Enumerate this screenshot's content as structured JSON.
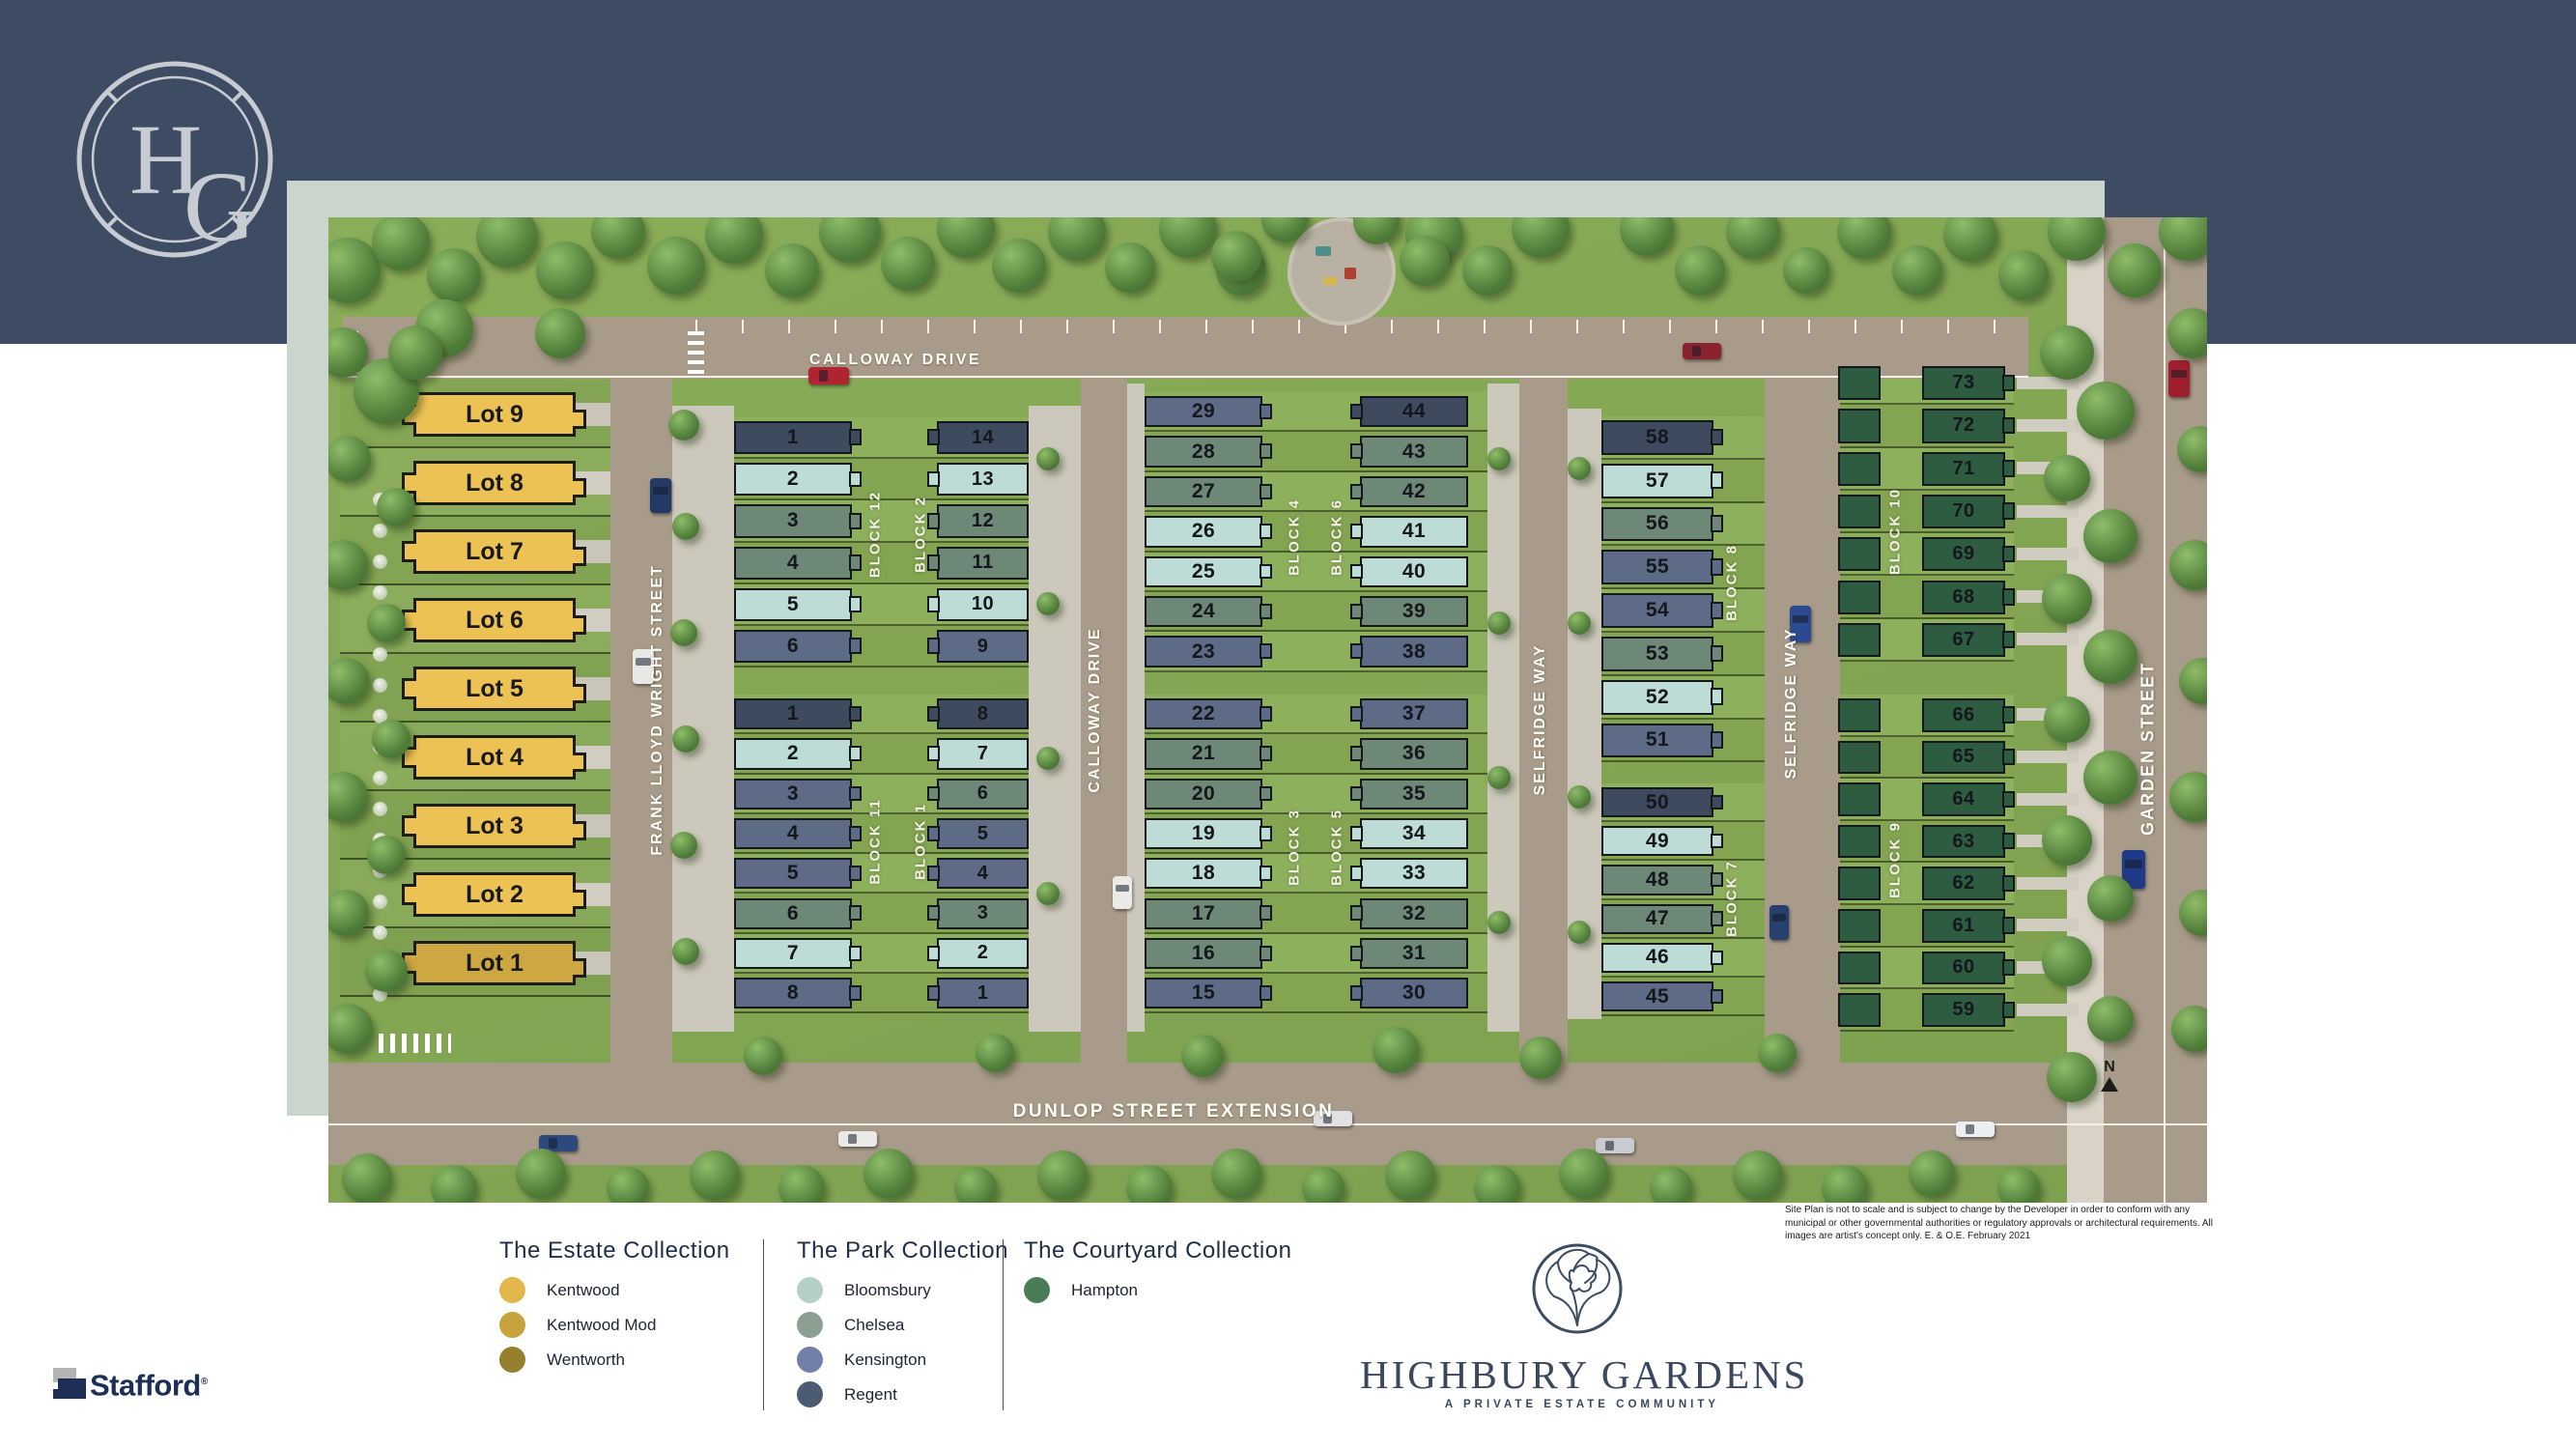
{
  "brand": {
    "monogram_h": "H",
    "monogram_g": "G"
  },
  "site": {
    "streets": {
      "calloway_top": "CALLOWAY DRIVE",
      "calloway_vertical": "CALLOWAY DRIVE",
      "frank_lloyd_wright": "FRANK LLOYD WRIGHT STREET",
      "selfridge_left": "SELFRIDGE WAY",
      "selfridge_right": "SELFRIDGE WAY",
      "garden": "GARDEN STREET",
      "dunlop": "DUNLOP STREET EXTENSION"
    },
    "north_label": "N",
    "estate_lots": [
      {
        "label": "Lot 9",
        "model": "kentwood"
      },
      {
        "label": "Lot 8",
        "model": "kentwood"
      },
      {
        "label": "Lot 7",
        "model": "kentwood"
      },
      {
        "label": "Lot 6",
        "model": "kentwood"
      },
      {
        "label": "Lot 5",
        "model": "kentwood"
      },
      {
        "label": "Lot 4",
        "model": "kentwood"
      },
      {
        "label": "Lot 3",
        "model": "kentwood"
      },
      {
        "label": "Lot 2",
        "model": "kentwood"
      },
      {
        "label": "Lot 1",
        "model": "kentwood_mod"
      }
    ],
    "blocks": {
      "block12": {
        "label": "BLOCK 12",
        "units": [
          [
            "1",
            "regent"
          ],
          [
            "2",
            "bloomsbury"
          ],
          [
            "3",
            "chelsea"
          ],
          [
            "4",
            "chelsea"
          ],
          [
            "5",
            "bloomsbury"
          ],
          [
            "6",
            "kensington"
          ]
        ]
      },
      "block2": {
        "label": "BLOCK 2",
        "units": [
          [
            "14",
            "regent"
          ],
          [
            "13",
            "bloomsbury"
          ],
          [
            "12",
            "chelsea"
          ],
          [
            "11",
            "chelsea"
          ],
          [
            "10",
            "bloomsbury"
          ],
          [
            "9",
            "kensington"
          ]
        ]
      },
      "block11": {
        "label": "BLOCK 11",
        "units": [
          [
            "1",
            "regent"
          ],
          [
            "2",
            "bloomsbury"
          ],
          [
            "3",
            "kensington"
          ],
          [
            "4",
            "kensington"
          ],
          [
            "5",
            "kensington"
          ],
          [
            "6",
            "chelsea"
          ],
          [
            "7",
            "bloomsbury"
          ],
          [
            "8",
            "kensington"
          ]
        ]
      },
      "block1": {
        "label": "BLOCK 1",
        "units": [
          [
            "8",
            "regent"
          ],
          [
            "7",
            "bloomsbury"
          ],
          [
            "6",
            "chelsea"
          ],
          [
            "5",
            "kensington"
          ],
          [
            "4",
            "kensington"
          ],
          [
            "3",
            "chelsea"
          ],
          [
            "2",
            "bloomsbury"
          ],
          [
            "1",
            "kensington"
          ]
        ]
      },
      "block4": {
        "label": "BLOCK 4",
        "units": [
          [
            "29",
            "kensington"
          ],
          [
            "28",
            "chelsea"
          ],
          [
            "27",
            "chelsea"
          ],
          [
            "26",
            "bloomsbury"
          ],
          [
            "25",
            "bloomsbury"
          ],
          [
            "24",
            "chelsea"
          ],
          [
            "23",
            "kensington"
          ]
        ]
      },
      "block6": {
        "label": "BLOCK 6",
        "units": [
          [
            "44",
            "regent"
          ],
          [
            "43",
            "chelsea"
          ],
          [
            "42",
            "chelsea"
          ],
          [
            "41",
            "bloomsbury"
          ],
          [
            "40",
            "bloomsbury"
          ],
          [
            "39",
            "chelsea"
          ],
          [
            "38",
            "kensington"
          ]
        ]
      },
      "block3": {
        "label": "BLOCK 3",
        "units": [
          [
            "22",
            "kensington"
          ],
          [
            "21",
            "chelsea"
          ],
          [
            "20",
            "chelsea"
          ],
          [
            "19",
            "bloomsbury"
          ],
          [
            "18",
            "bloomsbury"
          ],
          [
            "17",
            "chelsea"
          ],
          [
            "16",
            "chelsea"
          ],
          [
            "15",
            "kensington"
          ]
        ]
      },
      "block5": {
        "label": "BLOCK 5",
        "units": [
          [
            "37",
            "kensington"
          ],
          [
            "36",
            "chelsea"
          ],
          [
            "35",
            "chelsea"
          ],
          [
            "34",
            "bloomsbury"
          ],
          [
            "33",
            "bloomsbury"
          ],
          [
            "32",
            "chelsea"
          ],
          [
            "31",
            "chelsea"
          ],
          [
            "30",
            "kensington"
          ]
        ]
      },
      "block8": {
        "label": "BLOCK 8",
        "units": [
          [
            "58",
            "regent"
          ],
          [
            "57",
            "bloomsbury"
          ],
          [
            "56",
            "chelsea"
          ],
          [
            "55",
            "kensington"
          ],
          [
            "54",
            "kensington"
          ],
          [
            "53",
            "chelsea"
          ],
          [
            "52",
            "bloomsbury"
          ],
          [
            "51",
            "kensington"
          ]
        ]
      },
      "block7": {
        "label": "BLOCK 7",
        "units": [
          [
            "50",
            "regent"
          ],
          [
            "49",
            "bloomsbury"
          ],
          [
            "48",
            "chelsea"
          ],
          [
            "47",
            "chelsea"
          ],
          [
            "46",
            "bloomsbury"
          ],
          [
            "45",
            "kensington"
          ]
        ]
      },
      "block10": {
        "label": "BLOCK 10",
        "units": [
          [
            "73",
            "hampton"
          ],
          [
            "72",
            "hampton"
          ],
          [
            "71",
            "hampton"
          ],
          [
            "70",
            "hampton"
          ],
          [
            "69",
            "hampton"
          ],
          [
            "68",
            "hampton"
          ],
          [
            "67",
            "hampton"
          ]
        ]
      },
      "block9": {
        "label": "BLOCK 9",
        "units": [
          [
            "66",
            "hampton"
          ],
          [
            "65",
            "hampton"
          ],
          [
            "64",
            "hampton"
          ],
          [
            "63",
            "hampton"
          ],
          [
            "62",
            "hampton"
          ],
          [
            "61",
            "hampton"
          ],
          [
            "60",
            "hampton"
          ]
        ]
      }
    }
  },
  "models": {
    "kentwood": {
      "label": "Kentwood",
      "swatch": "#E2B64A",
      "plan": "#ECC254"
    },
    "kentwood_mod": {
      "label": "Kentwood Mod",
      "swatch": "#C7A33C",
      "plan": "#CDA742"
    },
    "wentworth": {
      "label": "Wentworth",
      "swatch": "#95802D",
      "plan": "#95802D"
    },
    "bloomsbury": {
      "label": "Bloomsbury",
      "swatch": "#B5CEC8",
      "plan": "#BEDCD6"
    },
    "chelsea": {
      "label": "Chelsea",
      "swatch": "#8C9F90",
      "plan": "#6E8878"
    },
    "kensington": {
      "label": "Kensington",
      "swatch": "#7280A9",
      "plan": "#5D6B86"
    },
    "regent": {
      "label": "Regent",
      "swatch": "#4B5B73",
      "plan": "#3E4A5E"
    },
    "hampton": {
      "label": "Hampton",
      "swatch": "#4A7C57",
      "plan": "#2D5C41"
    }
  },
  "block9_last_unit": [
    "59",
    "hampton"
  ],
  "legend": {
    "collections": [
      {
        "title": "The Estate Collection",
        "items": [
          "kentwood",
          "kentwood_mod",
          "wentworth"
        ]
      },
      {
        "title": "The Park Collection",
        "items": [
          "bloomsbury",
          "chelsea",
          "kensington",
          "regent"
        ]
      },
      {
        "title": "The Courtyard Collection",
        "items": [
          "hampton"
        ]
      }
    ]
  },
  "footer": {
    "community_name": "HIGHBURY GARDENS",
    "tagline": "A PRIVATE ESTATE COMMUNITY",
    "developer": "Stafford",
    "developer_mark": "®",
    "disclaimer": "Site Plan is not to scale and is subject to change by the Developer in order to conform with any municipal or other governmental authorities or regulatory approvals or architectural requirements. All images are artist's concept only. E. & O.E. February 2021"
  }
}
